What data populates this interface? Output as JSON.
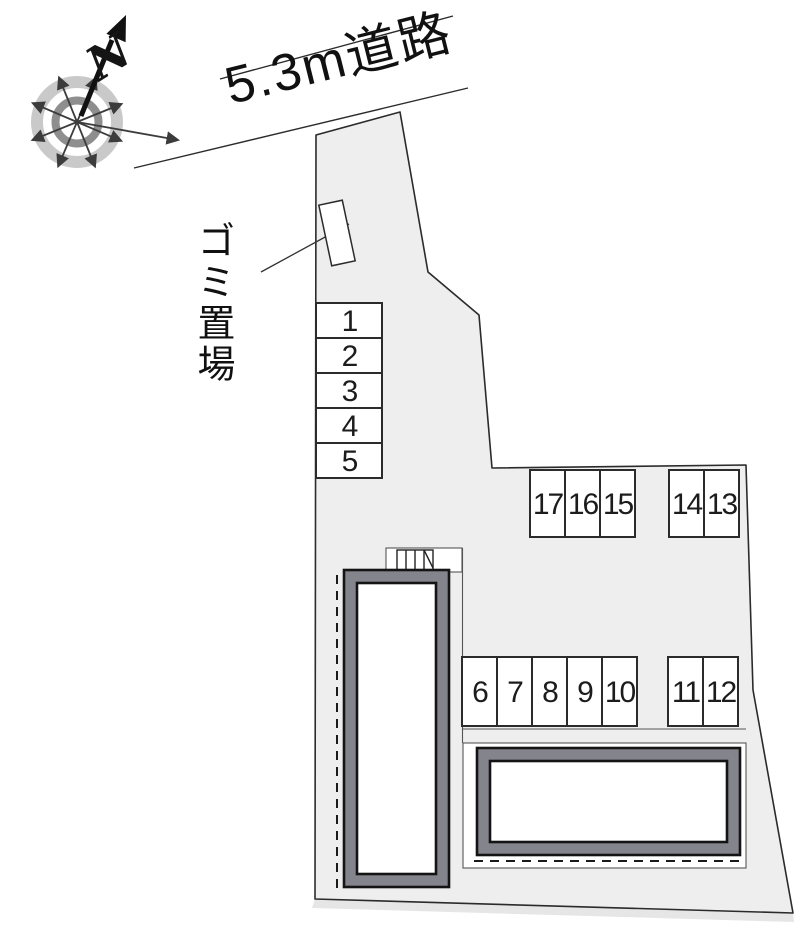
{
  "compass": {
    "north_label": "N"
  },
  "road": {
    "label": "5.3m道路"
  },
  "garbage": {
    "label": "ゴミ置場"
  },
  "parking": {
    "spaces": [
      "1",
      "2",
      "3",
      "4",
      "5",
      "6",
      "7",
      "8",
      "9",
      "10",
      "11",
      "12",
      "13",
      "14",
      "15",
      "16",
      "17"
    ]
  },
  "colors": {
    "site_fill": "#eeeeee",
    "boundary_line": "#2b2b2b",
    "building_wall": "#84848c",
    "building_interior": "#ffffff",
    "compass_outer_ring": "#c9c9c9",
    "compass_inner_ring": "#8e8e8e",
    "compass_arrows": "#3c3c3c",
    "north_arrow": "#111111"
  }
}
